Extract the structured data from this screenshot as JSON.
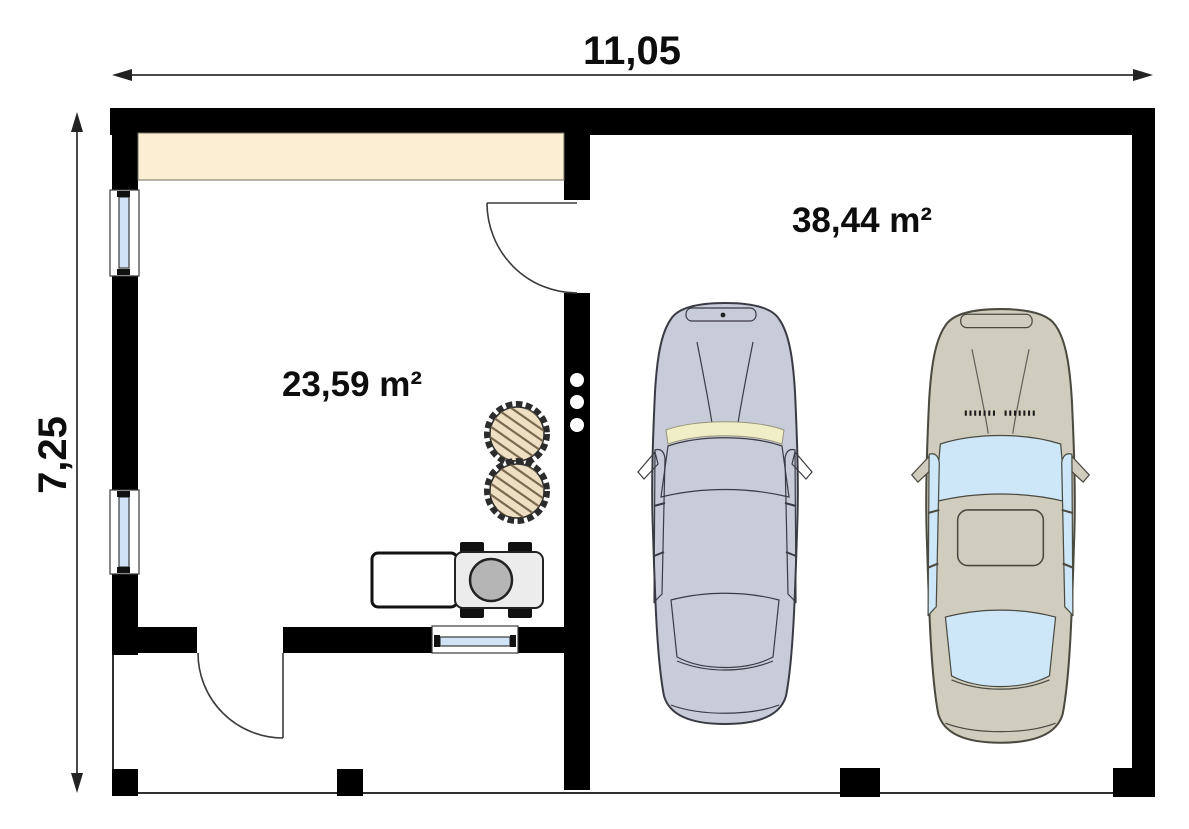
{
  "plan": {
    "type": "garage-floor-plan"
  },
  "dimensions": {
    "width_label": "11,05",
    "height_label": "7,25"
  },
  "rooms": {
    "workshop": {
      "area_label": "23,59 m²"
    },
    "garage": {
      "area_label": "38,44 m²"
    }
  },
  "colors": {
    "wall": "#000000",
    "dimension_line": "#4a4a4a",
    "band": "#fbeed3",
    "glass": "#cfe3f5",
    "car1_body": "#c8ccd9",
    "car1_glass": "#d7eafb",
    "car1_strip": "#efeec6",
    "car2_body": "#d0cdbf",
    "car2_glass": "#cde6f8",
    "table_fill": "#eedfc2",
    "table_hatch": "#7a6950",
    "mower_body": "#ececec",
    "steering": "#b5b5b5"
  }
}
